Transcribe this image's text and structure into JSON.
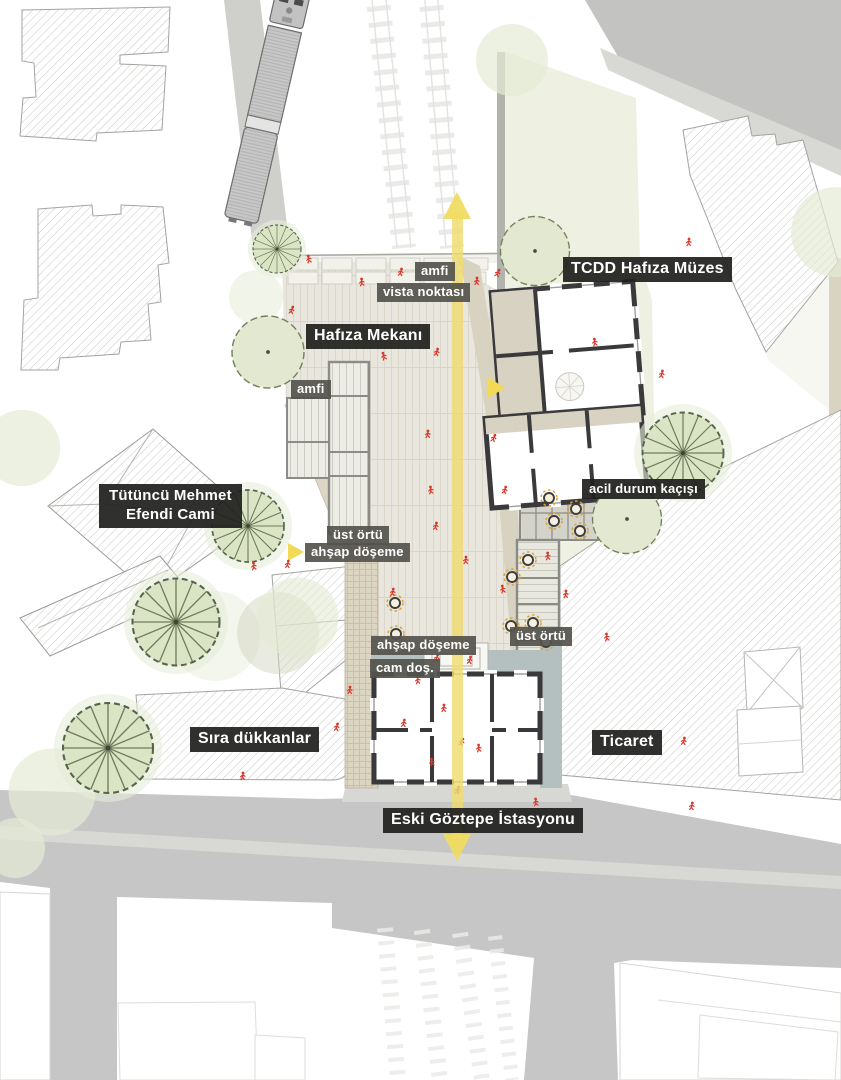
{
  "labels": {
    "top": {
      "amfi": "amfi",
      "vista_noktasi": "vista noktası"
    },
    "museum": {
      "tcdd": "TCDD Hafıza Müzes"
    },
    "plaza": {
      "hafiza_mekani": "Hafıza Mekanı",
      "amfi": "amfi",
      "ust_ortu_left": "üst örtü",
      "ahsap_doseme_upper": "ahşap döşeme",
      "acil_durum": "acil durum kaçışı",
      "ust_ortu_right": "üst örtü",
      "ahsap_doseme_lower": "ahşap döşeme",
      "cam_dos": "cam doş."
    },
    "context": {
      "cami_line1": "Tütüncü Mehmet",
      "cami_line2": "Efendi Cami",
      "sira_dukkanlar": "Sıra dükkanlar",
      "ticaret": "Ticaret",
      "istasyon": "Eski Göztepe İstasyonu"
    }
  },
  "colors": {
    "axis_yellow": "#f0dc6e",
    "arrow_yellow": "#f0dc62",
    "label_dark_bg": "#20201e",
    "label_gray_bg": "#54534d",
    "people_red": "#d8392b",
    "tree_green": "#dbe5c5",
    "paving_beige": "#e9e6dd",
    "wood_beige": "#dcd5c1",
    "glass_blue": "#b4bfc0",
    "wall_dark": "#39393b",
    "road_gray": "#c6c6c6"
  }
}
